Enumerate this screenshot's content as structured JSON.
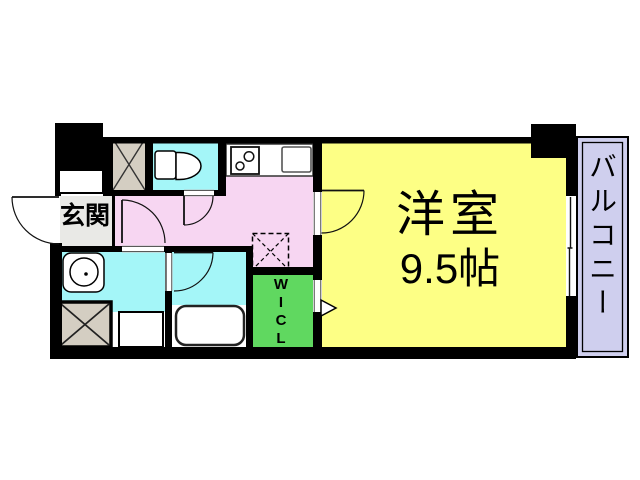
{
  "floor_plan": {
    "labels": {
      "entrance": "玄関",
      "room_name": "洋室",
      "room_size": "9.5帖",
      "closet_letters": [
        "W",
        "I",
        "C",
        "L"
      ],
      "balcony": "バルコニー"
    },
    "fixture_icons": [
      "toilet-icon",
      "stove-icon",
      "kitchen-sink-icon",
      "washbasin-icon",
      "bathtub-icon",
      "washing-machine-pan-icon",
      "refrigerator-space-dashed",
      "hatch-square-icon",
      "door-arc-icon",
      "sliding-window-icon",
      "entry-triangle-icon"
    ],
    "colors": {
      "wall": "#000000",
      "room_yellow": "#fdff85",
      "hall_pink": "#f7d6f2",
      "wet_area_cyan": "#a4f6f8",
      "closet_green": "#60d860",
      "balcony_lavender": "#cfcfee",
      "hatch_tan": "#d4cec2",
      "entrance_gray": "#e9e9e6",
      "fixture_white": "#ffffff"
    }
  }
}
